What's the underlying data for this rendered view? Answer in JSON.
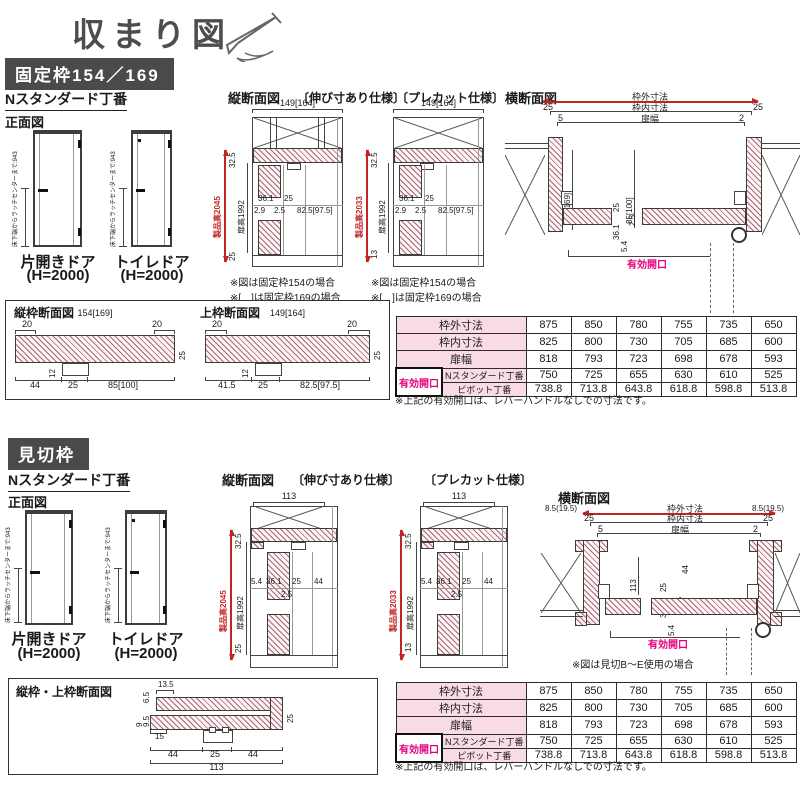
{
  "title": "収まり図",
  "s1": {
    "banner": "固定枠154／169",
    "hinge": "Nスタンダード丁番",
    "front": {
      "label": "正面図",
      "latch": "床下端からラッチセンターまで:943",
      "door1": "片開きドア",
      "door1_h": "(H=2000)",
      "door2": "トイレドア",
      "door2_h": "(H=2000)"
    },
    "vs_label": "縦断面図",
    "vs1": {
      "tag": "〔伸び寸あり仕様〕",
      "top": "149[164]",
      "product": "製品高2045",
      "door": "扉高1992",
      "gtop": "32.5",
      "gbot": "25",
      "d1": "36.1",
      "d2": "25",
      "d3": "2.9",
      "d4": "2.5",
      "d5": "82.5[97.5]"
    },
    "vs2": {
      "tag": "〔プレカット仕様〕",
      "top": "149[164]",
      "product": "製品高2033",
      "door": "扉高1992",
      "gtop": "32.5",
      "gbot": "13",
      "d1": "36.1",
      "d2": "25",
      "d3": "2.9",
      "d4": "2.5",
      "d5": "82.5[97.5]"
    },
    "note1": "※図は固定枠154の場合",
    "note2": "※[　]は固定枠169の場合",
    "hs": {
      "label": "横断面図",
      "outer": "枠外寸法",
      "inner": "枠内寸法",
      "doorw": "扉幅",
      "n25l": "25",
      "n25r": "25",
      "n5": "5",
      "n2": "2",
      "jamb": "154[169]",
      "mid": "85[100]",
      "d36": "36.1",
      "d25": "25",
      "d2_5": "2.5",
      "d5_4": "5.4",
      "opening": "有効開口"
    },
    "fs": {
      "label1": "縦枠断面図",
      "top1": "154[169]",
      "t20a": "20",
      "t20b": "20",
      "v25a": "25",
      "v12a": "12",
      "b1": "44",
      "b2": "25",
      "b3": "85[100]",
      "label2": "上枠断面図",
      "top2": "149[164]",
      "t20c": "20",
      "t20d": "20",
      "v25b": "25",
      "v12b": "12",
      "b4": "41.5",
      "b5": "25",
      "b6": "82.5[97.5]"
    }
  },
  "table": {
    "rows": [
      {
        "label": "枠外寸法",
        "v": [
          "875",
          "850",
          "780",
          "755",
          "735",
          "650"
        ]
      },
      {
        "label": "枠内寸法",
        "v": [
          "825",
          "800",
          "730",
          "705",
          "685",
          "600"
        ]
      },
      {
        "label": "扉幅",
        "v": [
          "818",
          "793",
          "723",
          "698",
          "678",
          "593"
        ]
      },
      {
        "label": "Nスタンダード丁番",
        "v": [
          "750",
          "725",
          "655",
          "630",
          "610",
          "525"
        ]
      },
      {
        "label": "ピボット丁番",
        "v": [
          "738.8",
          "713.8",
          "643.8",
          "618.8",
          "598.8",
          "513.8"
        ]
      }
    ],
    "opening": "有効開口",
    "note": "※上記の有効開口は、レバーハンドルなしでの寸法です。"
  },
  "s2": {
    "banner": "見切枠",
    "hinge": "Nスタンダード丁番",
    "front": {
      "label": "正面図",
      "latch": "床下端からラッチセンターまで:943",
      "door1": "片開きドア",
      "door1_h": "(H=2000)",
      "door2": "トイレドア",
      "door2_h": "(H=2000)"
    },
    "vs_label": "縦断面図",
    "vs1": {
      "tag": "〔伸び寸あり仕様〕",
      "top": "113",
      "product": "製品高2045",
      "door": "扉高1992",
      "gtop": "32.5",
      "gbot": "25",
      "d1": "5.4",
      "d2": "36.1",
      "d3": "25",
      "d4": "44",
      "d5": "2.5"
    },
    "vs2": {
      "tag": "〔プレカット仕様〕",
      "top": "113",
      "product": "製品高2033",
      "door": "扉高1992",
      "gtop": "32.5",
      "gbot": "13",
      "d1": "5.4",
      "d2": "36.1",
      "d3": "25",
      "d4": "44",
      "d5": "2.5"
    },
    "hs": {
      "label": "横断面図",
      "side_l": "8.5(19.5)",
      "side_r": "8.5(19.5)",
      "outer": "枠外寸法",
      "inner": "枠内寸法",
      "doorw": "扉幅",
      "n25l": "25",
      "n25r": "25",
      "n5": "5",
      "n2": "2",
      "v113": "113",
      "v44": "44",
      "v25": "25",
      "d36": "36.1",
      "d2_5": "2.5",
      "d5_4": "5.4",
      "opening": "有効開口",
      "note": "※図は見切B〜E使用の場合"
    },
    "fs": {
      "label": "縦枠・上枠断面図",
      "d135": "13.5",
      "d65": "6.5",
      "d95": "9.5",
      "d9": "9",
      "v25": "25",
      "d15": "15",
      "b1": "44",
      "b2": "25",
      "b3": "44",
      "b4": "113"
    }
  }
}
